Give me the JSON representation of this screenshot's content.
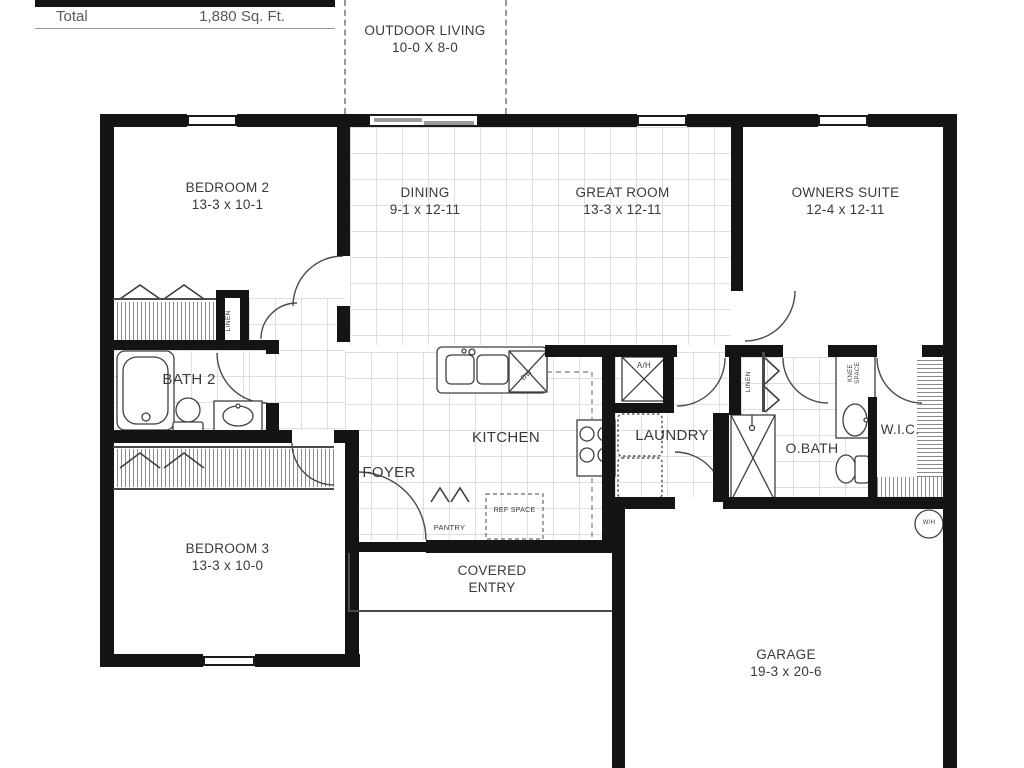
{
  "legend": {
    "label": "Total",
    "value": "1,880 Sq. Ft."
  },
  "outdoor_living": {
    "name": "OUTDOOR LIVING",
    "dims": "10-0 X 8-0"
  },
  "rooms": {
    "bedroom2": {
      "name": "BEDROOM 2",
      "dims": "13-3 x 10-1"
    },
    "dining": {
      "name": "DINING",
      "dims": "9-1 x 12-11"
    },
    "great_room": {
      "name": "GREAT ROOM",
      "dims": "13-3 x 12-11"
    },
    "owners_suite": {
      "name": "OWNERS SUITE",
      "dims": "12-4 x 12-11"
    },
    "bath2": {
      "name": "BATH 2"
    },
    "kitchen": {
      "name": "KITCHEN"
    },
    "laundry": {
      "name": "LAUNDRY"
    },
    "owners_bath": {
      "name": "O.BATH"
    },
    "wic": {
      "name": "W.I.C."
    },
    "foyer": {
      "name": "FOYER"
    },
    "bedroom3": {
      "name": "BEDROOM 3",
      "dims": "13-3 x 10-0"
    },
    "covered_entry": {
      "name": "COVERED ENTRY"
    },
    "garage": {
      "name": "GARAGE",
      "dims": "19-3 x 20-6"
    }
  },
  "fixtures": {
    "pantry": "PANTRY",
    "ref_space": "REF SPACE",
    "linen1": "LINEN",
    "linen2": "LINEN",
    "knee_space": "KNEE SPACE",
    "air_handler": "A/H",
    "dishwasher": "DW",
    "water_heater": "W/H"
  },
  "colors": {
    "wall": "#141414",
    "floor_grid": "#dedede",
    "text": "#3a3a3a"
  }
}
